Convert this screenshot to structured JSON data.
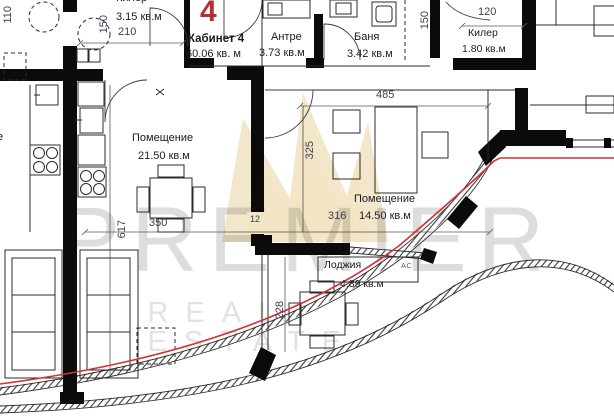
{
  "plan": {
    "unit_number": "4",
    "rooms": [
      {
        "id": "kiler_top",
        "name": "Килер",
        "area": "3.15 кв.м"
      },
      {
        "id": "kabinet",
        "name": "Кабинет 4",
        "area": "60.06 кв. м"
      },
      {
        "id": "antre",
        "name": "Антре",
        "area": "3.73 кв.м"
      },
      {
        "id": "banya",
        "name": "Баня",
        "area": "3.42 кв.м"
      },
      {
        "id": "kiler_right",
        "name": "Килер",
        "area": "1.80 кв.м"
      },
      {
        "id": "room_main",
        "name": "Помещение",
        "area": "21.50 кв.м"
      },
      {
        "id": "room_second",
        "name": "Помещение",
        "area": "14.50 кв.м"
      },
      {
        "id": "loggia",
        "name": "Лоджия",
        "area": "4.89 кв.м"
      }
    ],
    "annotations": {
      "ac": "АС",
      "neighbor_fragment": "е"
    },
    "dimensions": {
      "d110": "110",
      "d150_left": "150",
      "d210": "210",
      "d120": "120",
      "d150_right": "150",
      "d485": "485",
      "d325": "325",
      "d617": "617",
      "d350": "350",
      "d12": "12",
      "d316": "316",
      "d228": "228"
    },
    "watermark": {
      "brand": "PREMIER",
      "tagline": "REAL ESTATE"
    },
    "colors": {
      "wall": "#0b0b0b",
      "line": "#2b2b2b",
      "red_line": "#d03434",
      "unit_number_red": "#b52e31",
      "dim_text": "#39404f",
      "watermark_gray": "#d8d8d8",
      "crown_gold": "#d9b35c"
    }
  }
}
